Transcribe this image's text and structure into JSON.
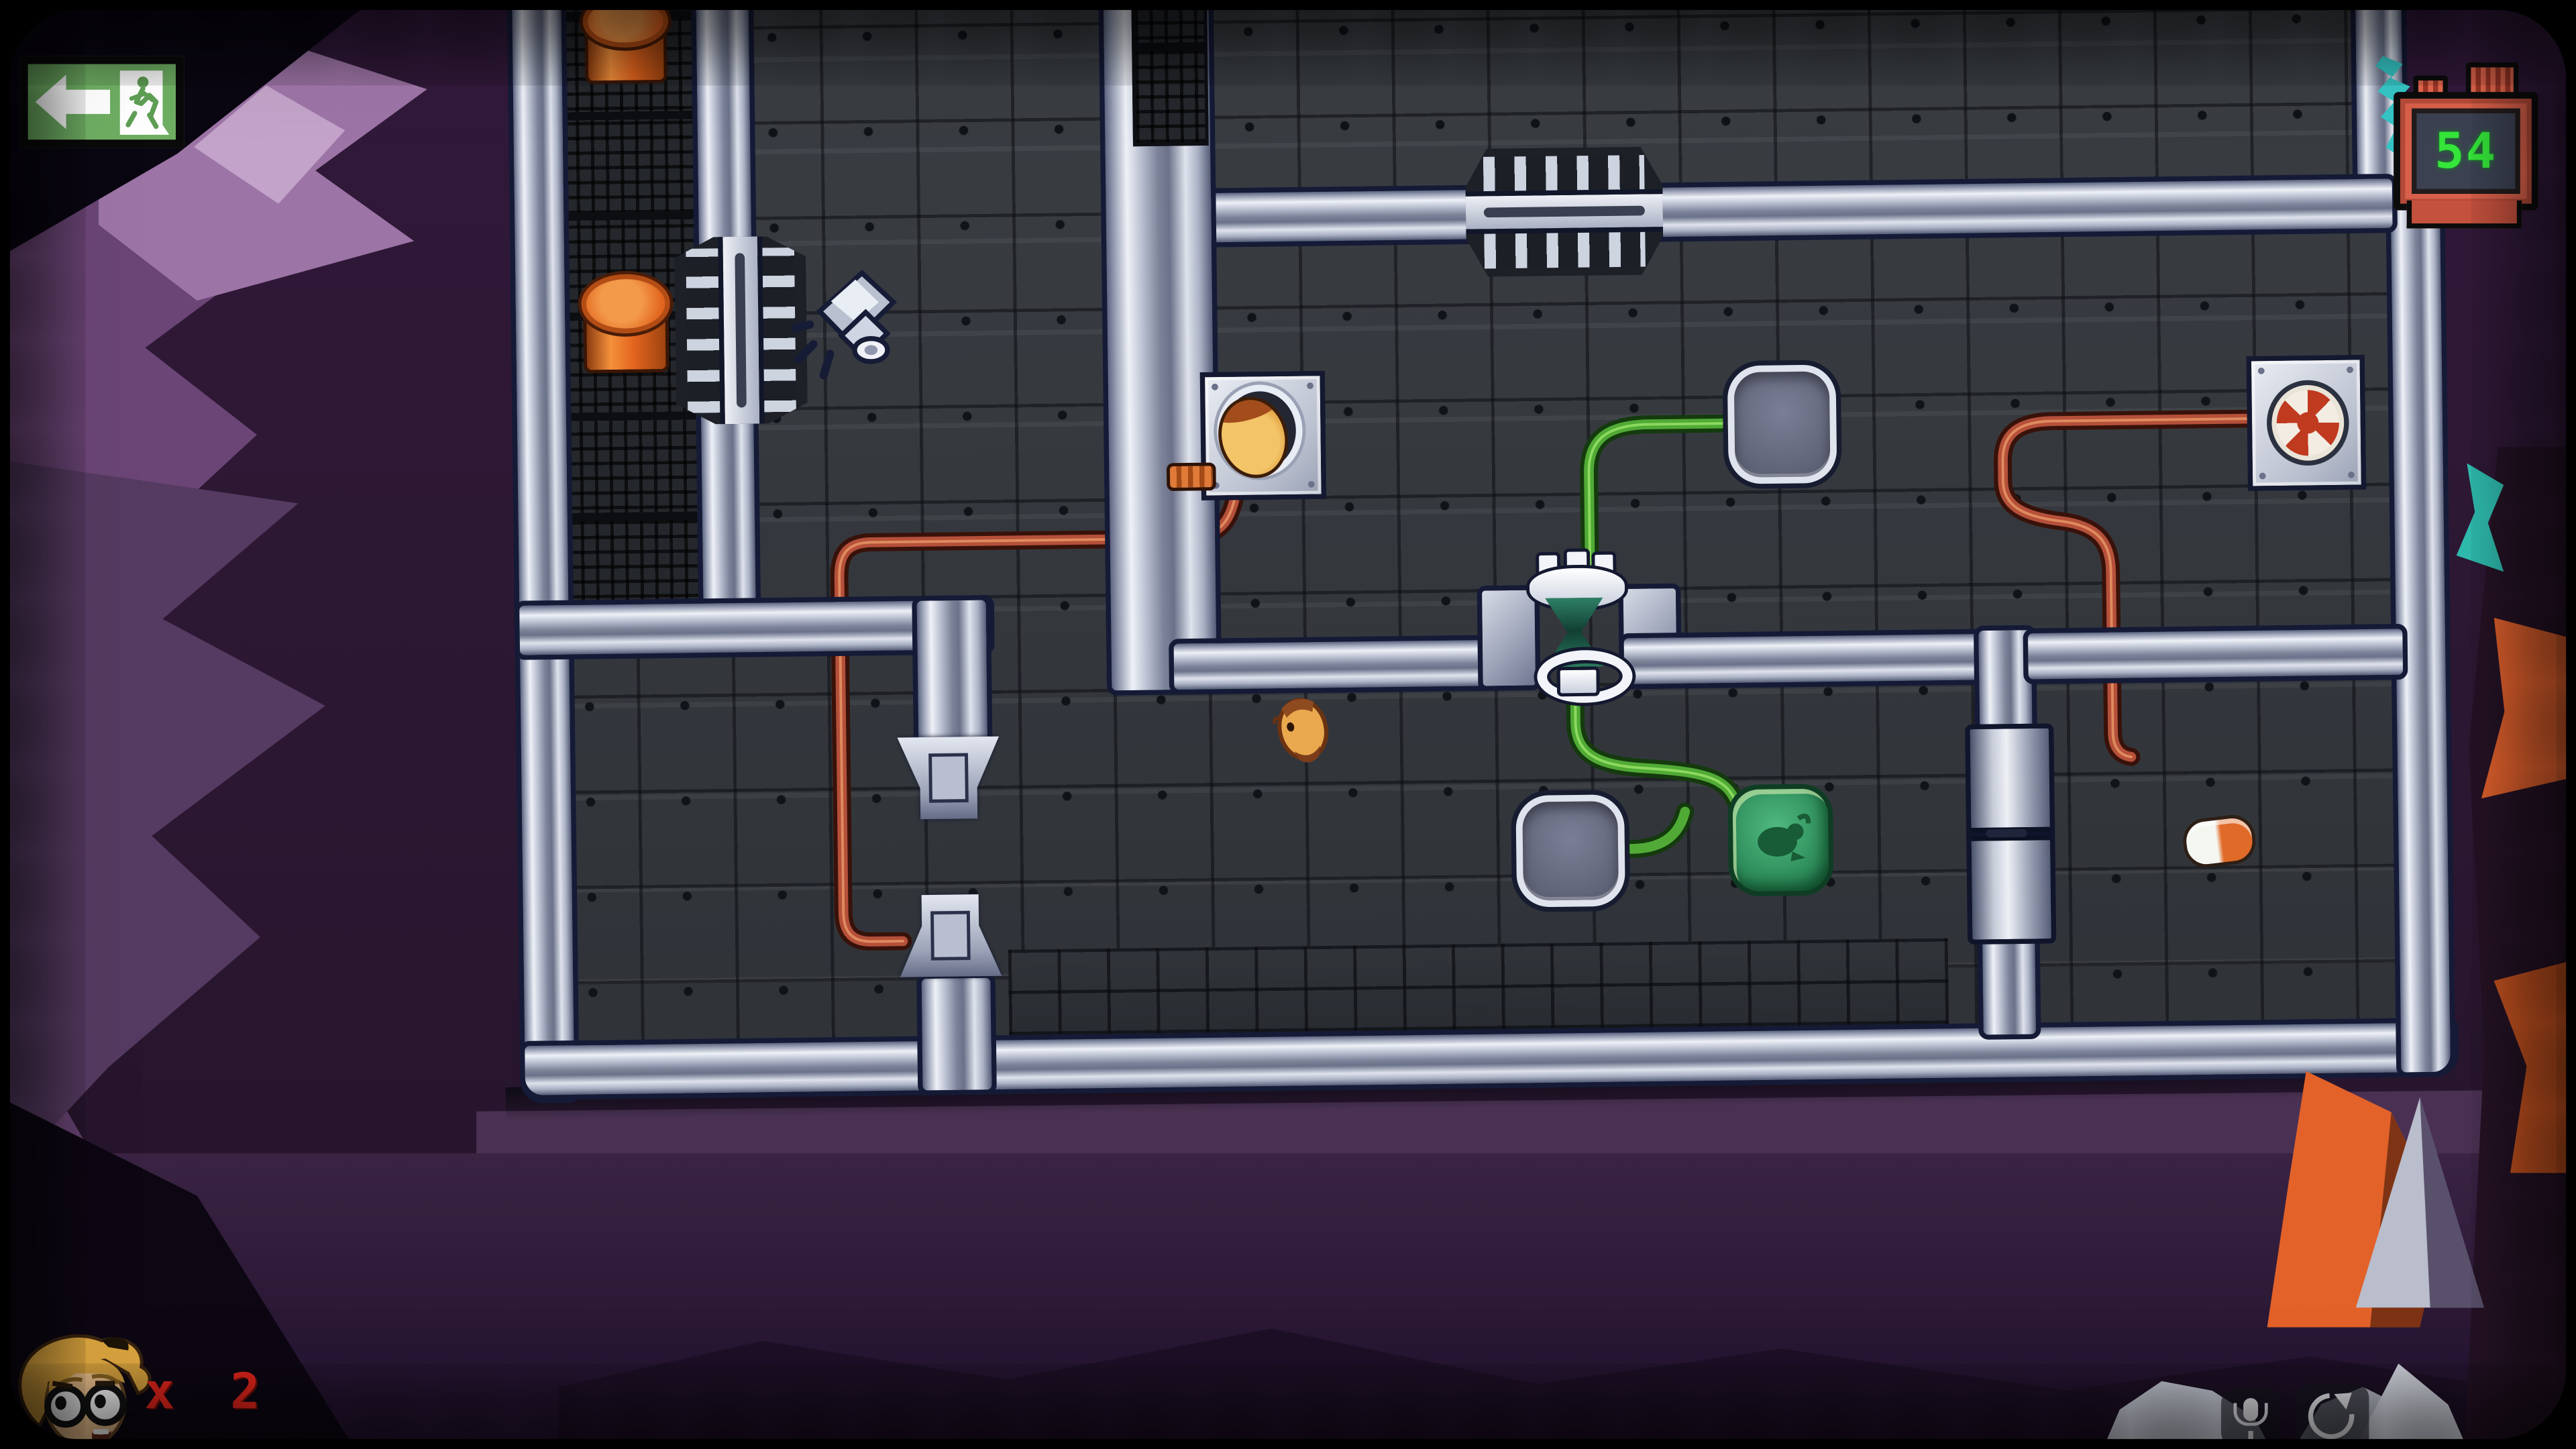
{
  "hud": {
    "exit_button": {
      "icon": "exit-door-running-man",
      "arrow_icon": "left-arrow"
    },
    "counter": {
      "value": "54",
      "digit_color": "#35e53a",
      "body_color": "#d9604a"
    },
    "lives": {
      "portrait_icon": "player-portrait-blonde-glasses",
      "label": "x 2",
      "color": "#e3251c"
    },
    "system_overlay": {
      "mic_icon": "microphone",
      "rotate_icon": "screen-rotate"
    }
  },
  "palette": {
    "background_purple": "#2b1731",
    "background_purple_light": "#6c4878",
    "wall_metal": "#aab1c6",
    "floor_tile": "#33373c",
    "wire_red": "#b5503a",
    "wire_green": "#51aa36",
    "goo_green": "#2c8a58",
    "barrel_orange": "#e2641e",
    "exit_green": "#6fae63",
    "rock_orange": "#e2622a",
    "teal_accent": "#35c4c4"
  },
  "scene": {
    "entities": [
      {
        "name": "orange-barrel",
        "count": 2
      },
      {
        "name": "wall-vent-gate",
        "count": 2
      },
      {
        "name": "security-camera",
        "count": 1
      },
      {
        "name": "hamster-wall-port",
        "count": 1
      },
      {
        "name": "hamster-creature",
        "count": 1
      },
      {
        "name": "pressure-plate",
        "count": 2
      },
      {
        "name": "hourglass-valve",
        "count": 1
      },
      {
        "name": "goo-pad-hamster-symbol",
        "count": 1
      },
      {
        "name": "target-panel",
        "count": 1
      },
      {
        "name": "sliding-door",
        "count": 1
      },
      {
        "name": "piston-doorway",
        "count": 1
      },
      {
        "name": "pill-capsule",
        "count": 1
      },
      {
        "name": "red-wire",
        "count": 2
      },
      {
        "name": "green-wire",
        "count": 1
      }
    ]
  }
}
